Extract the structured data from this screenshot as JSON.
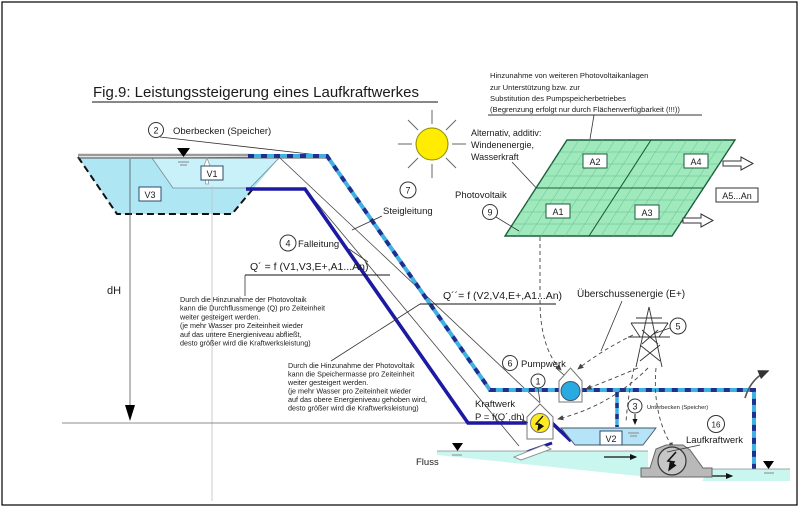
{
  "title": "Fig.9: Leistungssteigerung eines Laufkraftwerkes",
  "labels": {
    "oberbecken": {
      "num": "2",
      "text": "Oberbecken (Speicher)"
    },
    "steigleitung": {
      "num": "7",
      "text": "Steigleitung"
    },
    "falleitung": {
      "num": "4",
      "text": "Falleitung"
    },
    "photovoltaik": {
      "num": "9",
      "text": "Photovoltaik"
    },
    "pylon": {
      "num": "5"
    },
    "pumpwerk": {
      "num": "6",
      "text": "Pumpwerk"
    },
    "kraftwerk": {
      "num": "1",
      "name": "Kraftwerk",
      "formula": "P = f(Q´,dh)"
    },
    "unterbecken": {
      "num": "3",
      "text": "Unterbecken (Speicher)"
    },
    "laufkraftwerk": {
      "num": "16",
      "text": "Laufkraftwerk"
    },
    "surplus": "Überschussenergie (E+)",
    "fluss": "Fluss",
    "dh": "dH"
  },
  "formulas": {
    "q_prime": "Q´ = f (V1,V3,E+,A1...An)",
    "q_double_prime": "Q´´= f (V2,V4,E+,A1...An)"
  },
  "volumes": {
    "v1": "V1",
    "v2": "V2",
    "v3": "V3"
  },
  "panels": {
    "a1": "A1",
    "a2": "A2",
    "a3": "A3",
    "a4": "A4",
    "a5n": "A5...An"
  },
  "notes": {
    "pv_expansion": {
      "lines": [
        "Hinzunahme von weiteren Photovoltaikanlagen",
        "zur Unterstützung bzw. zur",
        "Substitution des Pumpspeicherbetriebes",
        "(Begrenzung erfolgt nur durch Flächenverfügbarkeit (!!!))"
      ]
    },
    "alternative": {
      "lines": [
        "Alternativ, additiv:",
        "Windenenergie,",
        "Wasserkraft"
      ]
    },
    "flow_increase": {
      "lines": [
        "Durch die Hinzunahme der Photovoltaik",
        "kann die Durchflussmenge (Q) pro Zeiteinheit",
        "weiter gesteigert werden.",
        "(je mehr Wasser pro Zeiteinheit wieder",
        "auf das untere Energieniveau abfließt,",
        "desto größer wird die Kraftwerksleistung)"
      ]
    },
    "storage_increase": {
      "lines": [
        "Durch die Hinzunahme der Photovoltaik",
        "kann die Speichermasse pro Zeiteinheit",
        "weiter gesteigert werden.",
        "(je mehr Wasser pro Zeiteinheit wieder",
        "auf das obere Energieniveau gehoben wird,",
        "desto größer wird die Kraftwerksleistung)"
      ]
    }
  },
  "colors": {
    "pipe_cyan": "#3fb0e0",
    "pipe_navy": "#1c19a3",
    "pv_green": "#9fe9bd",
    "reservoir_outer": "#aee6f4",
    "reservoir_inner": "#c9f1fa",
    "basin_v2": "#b5e3f7",
    "river": "#c9f6ee",
    "note_red": "#cc0000",
    "sun_yellow": "#ffec00",
    "pump_blue": "#29abe2",
    "generator_yellow": "#ffe920",
    "dam_gray": "#b9b9b9"
  }
}
